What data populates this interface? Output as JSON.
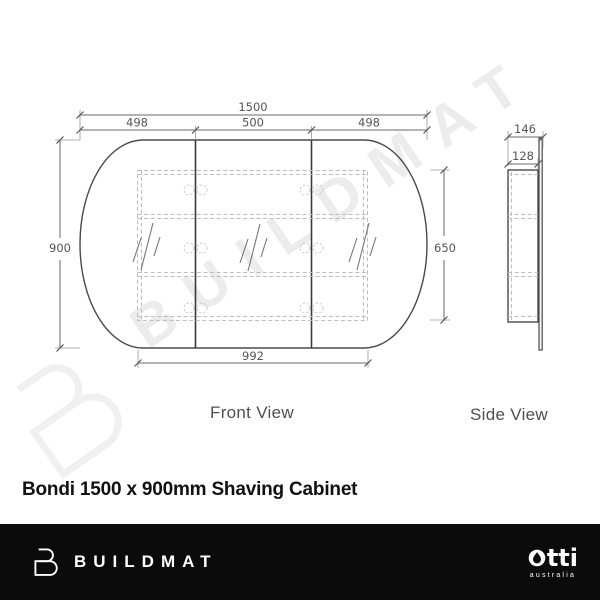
{
  "watermark": {
    "text": "BUILDMAT"
  },
  "drawing": {
    "front_view": {
      "label": "Front View",
      "dim_overall_width": "1500",
      "dim_door_left": "498",
      "dim_door_middle": "500",
      "dim_door_right": "498",
      "dim_overall_height": "900",
      "dim_carcass_height": "650",
      "dim_carcass_width": "992"
    },
    "side_view": {
      "label": "Side View",
      "dim_total_depth": "146",
      "dim_cabinet_depth": "128"
    }
  },
  "product": {
    "title": "Bondi 1500 x 900mm Shaving Cabinet"
  },
  "footer": {
    "brand": "BUILDMAT",
    "partner": {
      "name": "otti",
      "display_suffix": "tti",
      "tagline": "australia"
    }
  },
  "colors": {
    "footer_bar": "#0b0b0b",
    "drawing_line": "#4a4a4a",
    "dimension_text": "#555555",
    "hidden_line": "#bdbdbd",
    "watermark": "#ececec"
  }
}
